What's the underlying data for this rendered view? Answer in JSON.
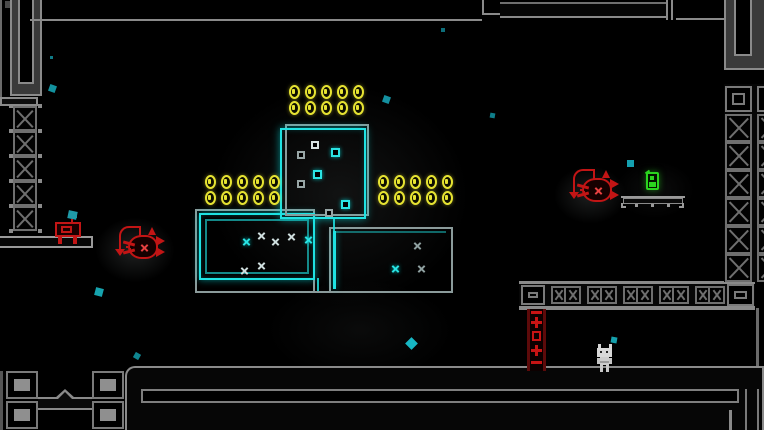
{
  "scene": {
    "width": 764,
    "height": 430,
    "background": "#000000",
    "description": "dark neon platformer room"
  },
  "palette": {
    "wall_gray": "#8a8a8a",
    "dim_gray": "#4a4a4a",
    "neon_cyan": "#1fe2e2",
    "coin_yellow": "#e6e332",
    "enemy_red": "#c21515",
    "item_green": "#2bd41f",
    "particle_teal": "#1293a0",
    "player_gray": "#d8d8d8",
    "ladder_dark_red": "#5c0a0a"
  },
  "coins": {
    "total": 30,
    "rows": 2,
    "cols": 5,
    "pitch_x": 16,
    "pitch_y": 16,
    "coin_w": 11,
    "coin_h": 14,
    "groups": [
      {
        "name": "coin-group-top",
        "x": 289,
        "y": 85
      },
      {
        "name": "coin-group-left",
        "x": 205,
        "y": 175
      },
      {
        "name": "coin-group-right",
        "x": 378,
        "y": 175
      }
    ]
  },
  "rooms": {
    "top": {
      "x": 280,
      "y": 124,
      "w": 88,
      "h": 95
    },
    "left": {
      "x": 195,
      "y": 209,
      "w": 124,
      "h": 84
    },
    "right": {
      "x": 329,
      "y": 227,
      "w": 124,
      "h": 68
    }
  },
  "room_squares": [
    {
      "x": 311,
      "y": 141,
      "s": 8,
      "c": "white"
    },
    {
      "x": 331,
      "y": 148,
      "s": 9,
      "c": "cyan"
    },
    {
      "x": 297,
      "y": 151,
      "s": 8,
      "c": "gray"
    },
    {
      "x": 313,
      "y": 170,
      "s": 9,
      "c": "cyan"
    },
    {
      "x": 297,
      "y": 180,
      "s": 8,
      "c": "gray"
    },
    {
      "x": 341,
      "y": 200,
      "s": 9,
      "c": "cyan"
    },
    {
      "x": 325,
      "y": 209,
      "s": 8,
      "c": "gray"
    }
  ],
  "room_marks": [
    {
      "x": 242,
      "y": 237,
      "c": "cyan"
    },
    {
      "x": 257,
      "y": 231,
      "c": "white"
    },
    {
      "x": 271,
      "y": 237,
      "c": "white"
    },
    {
      "x": 287,
      "y": 232,
      "c": "white"
    },
    {
      "x": 304,
      "y": 235,
      "c": "cyan"
    },
    {
      "x": 257,
      "y": 261,
      "c": "white"
    },
    {
      "x": 240,
      "y": 266,
      "c": "white"
    },
    {
      "x": 413,
      "y": 241,
      "c": "gray"
    },
    {
      "x": 391,
      "y": 264,
      "c": "cyan"
    },
    {
      "x": 417,
      "y": 264,
      "c": "gray"
    }
  ],
  "particles": [
    {
      "x": 50,
      "y": 56,
      "s": 3,
      "r": 0,
      "c": "#0f7a86"
    },
    {
      "x": 49,
      "y": 85,
      "s": 7,
      "r": 20,
      "c": "#12919e"
    },
    {
      "x": 71,
      "y": 212,
      "s": 6,
      "r": 0,
      "c": "#139aa6"
    },
    {
      "x": 95,
      "y": 288,
      "s": 8,
      "r": 15,
      "c": "#16a3ae"
    },
    {
      "x": 134,
      "y": 353,
      "s": 6,
      "r": 30,
      "c": "#0f8590"
    },
    {
      "x": 383,
      "y": 96,
      "s": 7,
      "r": 20,
      "c": "#1490a0"
    },
    {
      "x": 441,
      "y": 28,
      "s": 4,
      "r": 0,
      "c": "#0d6e7a"
    },
    {
      "x": 490,
      "y": 113,
      "s": 5,
      "r": 10,
      "c": "#0e7e8a"
    },
    {
      "x": 407,
      "y": 339,
      "s": 9,
      "r": 45,
      "c": "#17b7c4"
    },
    {
      "x": 627,
      "y": 160,
      "s": 7,
      "r": 0,
      "c": "#14a0b0"
    },
    {
      "x": 611,
      "y": 337,
      "s": 6,
      "r": 10,
      "c": "#15a0ac"
    }
  ],
  "glows": [
    {
      "name": "glow-center",
      "x": 160,
      "y": 40,
      "w": 360,
      "h": 310,
      "a": 0.09
    },
    {
      "name": "glow-left-fish",
      "x": 80,
      "y": 205,
      "w": 110,
      "h": 90,
      "a": 0.16
    },
    {
      "name": "glow-right-fish",
      "x": 540,
      "y": 155,
      "w": 100,
      "h": 80,
      "a": 0.15
    },
    {
      "name": "glow-bottom-center",
      "x": 230,
      "y": 260,
      "w": 260,
      "h": 140,
      "a": 0.05
    },
    {
      "name": "glow-item",
      "x": 600,
      "y": 150,
      "w": 110,
      "h": 80,
      "a": 0.06
    }
  ],
  "blocks": [
    {
      "t": "x",
      "x": 13,
      "y": 106,
      "w": 24,
      "h": 25,
      "area": "left-column"
    },
    {
      "t": "x",
      "x": 13,
      "y": 131,
      "w": 24,
      "h": 25,
      "area": "left-column"
    },
    {
      "t": "x",
      "x": 13,
      "y": 156,
      "w": 24,
      "h": 25,
      "area": "left-column"
    },
    {
      "t": "x",
      "x": 13,
      "y": 181,
      "w": 24,
      "h": 25,
      "area": "left-column"
    },
    {
      "t": "x",
      "x": 13,
      "y": 206,
      "w": 24,
      "h": 25,
      "area": "left-column"
    },
    {
      "t": "sq",
      "x": 725,
      "y": 86,
      "w": 27,
      "h": 26,
      "area": "right-wall"
    },
    {
      "t": "x",
      "x": 725,
      "y": 114,
      "w": 27,
      "h": 28,
      "area": "right-wall"
    },
    {
      "t": "x",
      "x": 725,
      "y": 142,
      "w": 27,
      "h": 28,
      "area": "right-wall"
    },
    {
      "t": "x",
      "x": 725,
      "y": 170,
      "w": 27,
      "h": 28,
      "area": "right-wall"
    },
    {
      "t": "x",
      "x": 725,
      "y": 198,
      "w": 27,
      "h": 28,
      "area": "right-wall"
    },
    {
      "t": "x",
      "x": 725,
      "y": 226,
      "w": 27,
      "h": 28,
      "area": "right-wall"
    },
    {
      "t": "x",
      "x": 725,
      "y": 254,
      "w": 27,
      "h": 28,
      "area": "right-wall"
    },
    {
      "t": "sq",
      "x": 757,
      "y": 86,
      "w": 27,
      "h": 26,
      "area": "right-wall-edge"
    },
    {
      "t": "x",
      "x": 757,
      "y": 114,
      "w": 27,
      "h": 28,
      "area": "right-wall-edge"
    },
    {
      "t": "x",
      "x": 757,
      "y": 142,
      "w": 27,
      "h": 28,
      "area": "right-wall-edge"
    },
    {
      "t": "x",
      "x": 757,
      "y": 170,
      "w": 27,
      "h": 28,
      "area": "right-wall-edge"
    },
    {
      "t": "x",
      "x": 757,
      "y": 198,
      "w": 27,
      "h": 28,
      "area": "right-wall-edge"
    },
    {
      "t": "x",
      "x": 757,
      "y": 226,
      "w": 27,
      "h": 28,
      "area": "right-wall-edge"
    },
    {
      "t": "x",
      "x": 757,
      "y": 254,
      "w": 27,
      "h": 28,
      "area": "right-wall-edge"
    },
    {
      "t": "sq",
      "x": 521,
      "y": 285,
      "w": 24,
      "h": 20,
      "area": "beam"
    },
    {
      "t": "sq",
      "x": 727,
      "y": 284,
      "w": 27,
      "h": 22,
      "area": "beam"
    },
    {
      "t": "xx",
      "x": 551,
      "y": 286,
      "w": 30,
      "h": 18,
      "area": "beam"
    },
    {
      "t": "xx",
      "x": 587,
      "y": 286,
      "w": 30,
      "h": 18,
      "area": "beam"
    },
    {
      "t": "xx",
      "x": 623,
      "y": 286,
      "w": 30,
      "h": 18,
      "area": "beam"
    },
    {
      "t": "xx",
      "x": 659,
      "y": 286,
      "w": 30,
      "h": 18,
      "area": "beam"
    },
    {
      "t": "xx",
      "x": 695,
      "y": 286,
      "w": 30,
      "h": 18,
      "area": "beam"
    },
    {
      "t": "sqf",
      "x": 6,
      "y": 371,
      "w": 32,
      "h": 28,
      "area": "pillar"
    },
    {
      "t": "sqf",
      "x": 6,
      "y": 401,
      "w": 32,
      "h": 28,
      "area": "pillar"
    },
    {
      "t": "sqf",
      "x": 92,
      "y": 371,
      "w": 32,
      "h": 28,
      "area": "pillar"
    },
    {
      "t": "sqf",
      "x": 92,
      "y": 401,
      "w": 32,
      "h": 28,
      "area": "pillar"
    }
  ],
  "entities": {
    "player": {
      "type": "robot-character",
      "x": 595,
      "y": 342
    },
    "enemy_left": {
      "type": "anglerfish",
      "x": 112,
      "y": 221,
      "color": "#c21515"
    },
    "enemy_right": {
      "type": "anglerfish",
      "x": 566,
      "y": 164,
      "color": "#c21515"
    },
    "checkpoint": {
      "type": "save-station",
      "x": 54,
      "y": 208,
      "flag_color": "#1f9aa8"
    },
    "battery": {
      "type": "green-item",
      "x": 644,
      "y": 169,
      "color": "#2bd41f"
    },
    "bench": {
      "type": "small-platform",
      "x": 621,
      "y": 195,
      "w": 64
    },
    "ladder": {
      "type": "red-ladder",
      "x": 527,
      "y": 309,
      "w": 19,
      "h": 62,
      "rungs": [
        "bar",
        "cross",
        "square",
        "cross",
        "bar"
      ]
    }
  }
}
